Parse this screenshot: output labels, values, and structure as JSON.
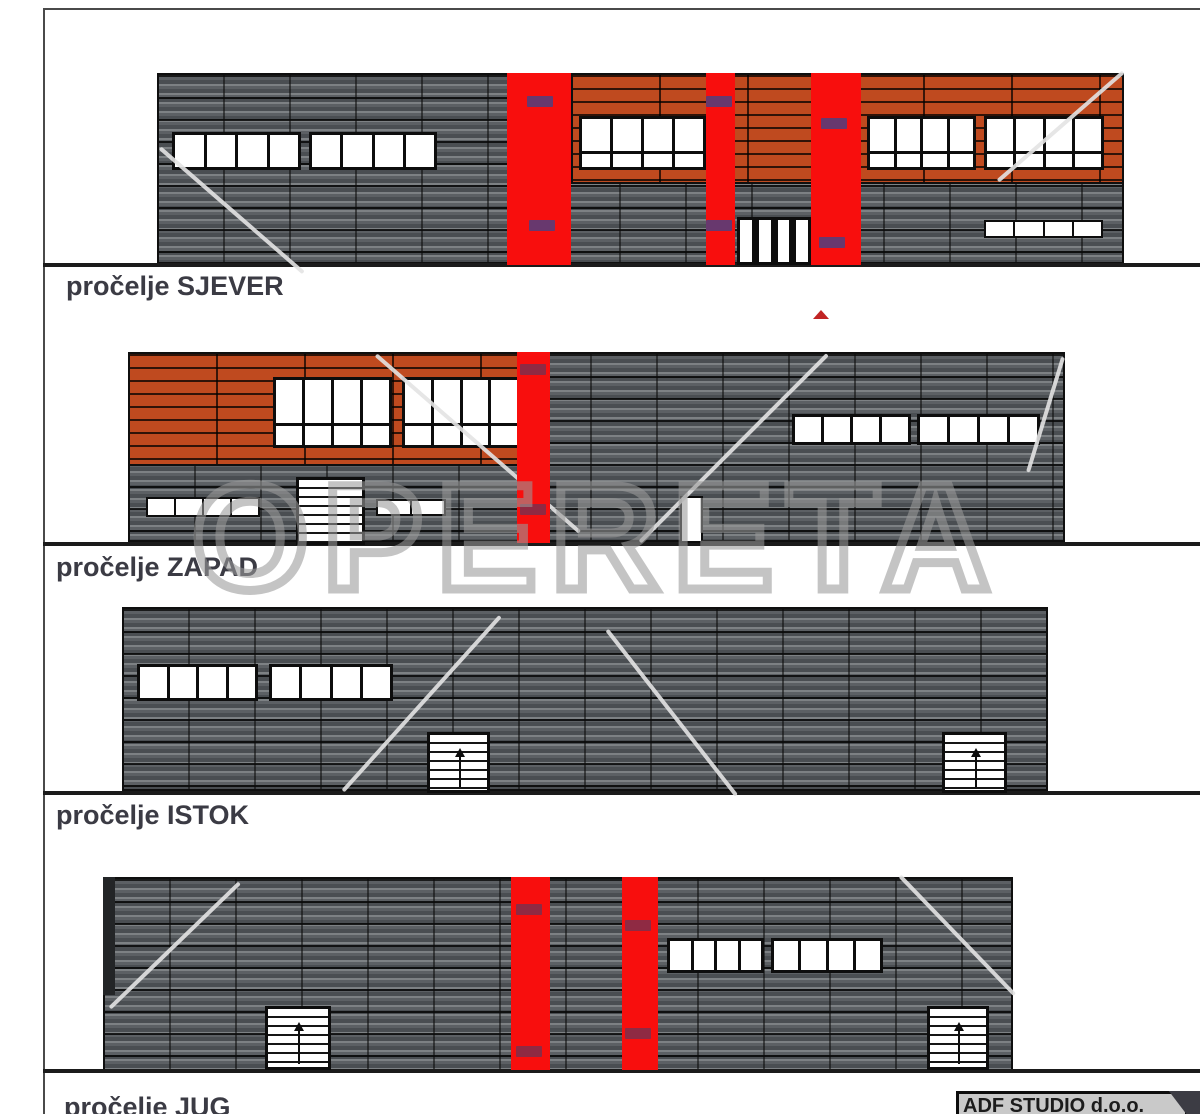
{
  "watermark": {
    "text": "OPERETA"
  },
  "elevations": [
    {
      "label": "pročelje SJEVER"
    },
    {
      "label": "pročelje ZAPAD"
    },
    {
      "label": "pročelje ISTOK"
    },
    {
      "label": "pročelje JUG"
    }
  ],
  "stamp": {
    "company": "ADF STUDIO d.o.o."
  },
  "colors": {
    "cladding_gray": "#54585c",
    "facade_orange": "#bf4a1f",
    "accent_red": "#f80e0d",
    "watermark_gray": "#9a9a9a"
  }
}
